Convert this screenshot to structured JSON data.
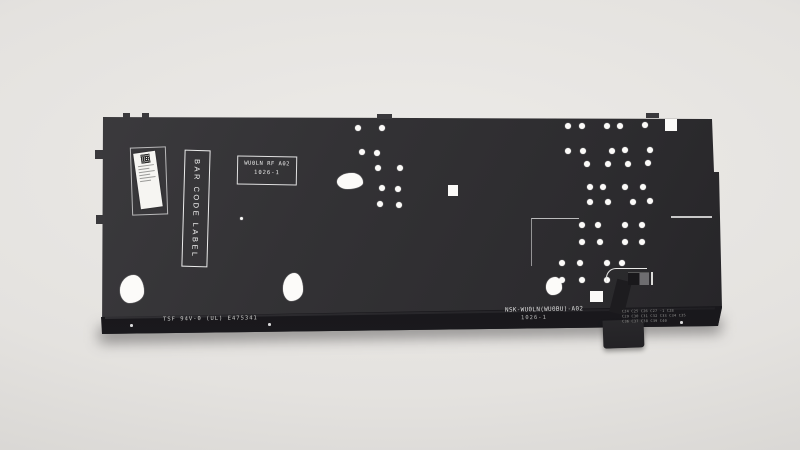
{
  "scene": {
    "description": "Product photo of a laptop keyboard backplate (NSK-WU0LN) on a light gray studio background",
    "background_color": "#e7e5e2",
    "panel_color": "#323134",
    "strip_color": "#18171a",
    "hole_color": "#fbfaf8"
  },
  "markings": {
    "stamp_line1": "WU0LN RF A02",
    "stamp_line2": "1026-1",
    "barcode_box_label": "BAR CODE LABEL",
    "ul_marking": "TSF 94V-0 (UL) E475341",
    "part_number": "NSK-WU0LN(WU0BU)-A02",
    "date_code": "1026-1",
    "component_refs": [
      "C24 C25 C26 C27 -1 C28",
      "C29 C30 C31 C32 C33 C34 C35",
      "C36 C37 C38 C39 C40"
    ]
  },
  "panel": {
    "holes": [
      [
        263,
        18
      ],
      [
        287,
        18
      ],
      [
        267,
        42
      ],
      [
        282,
        43
      ],
      [
        283,
        58
      ],
      [
        305,
        58
      ],
      [
        287,
        78
      ],
      [
        303,
        79
      ],
      [
        285,
        94
      ],
      [
        304,
        95
      ],
      [
        473,
        16
      ],
      [
        487,
        16
      ],
      [
        512,
        16
      ],
      [
        525,
        16
      ],
      [
        550,
        15
      ],
      [
        473,
        41
      ],
      [
        488,
        41
      ],
      [
        517,
        41
      ],
      [
        530,
        40
      ],
      [
        555,
        40
      ],
      [
        492,
        54
      ],
      [
        513,
        54
      ],
      [
        533,
        54
      ],
      [
        553,
        53
      ],
      [
        495,
        77
      ],
      [
        508,
        77
      ],
      [
        530,
        77
      ],
      [
        548,
        77
      ],
      [
        495,
        92
      ],
      [
        513,
        92
      ],
      [
        538,
        92
      ],
      [
        555,
        91
      ],
      [
        487,
        115
      ],
      [
        503,
        115
      ],
      [
        530,
        115
      ],
      [
        547,
        115
      ],
      [
        487,
        132
      ],
      [
        505,
        132
      ],
      [
        530,
        132
      ],
      [
        547,
        132
      ],
      [
        467,
        153
      ],
      [
        485,
        153
      ],
      [
        512,
        153
      ],
      [
        527,
        153
      ],
      [
        467,
        170
      ],
      [
        487,
        170
      ],
      [
        512,
        170
      ]
    ],
    "small_holes": [
      [
        146,
        108
      ]
    ],
    "square_holes": [
      [
        353,
        75,
        10,
        11
      ],
      [
        570,
        9,
        12,
        12
      ],
      [
        495,
        181,
        13,
        11
      ]
    ],
    "stabilizer_cutouts": [
      [
        242,
        63,
        26,
        16
      ],
      [
        25,
        165,
        24,
        28
      ],
      [
        188,
        163,
        20,
        28
      ],
      [
        451,
        167,
        16,
        18
      ]
    ],
    "edge_tabs_left": [
      [
        0,
        40,
        9,
        9
      ],
      [
        1,
        105,
        9,
        9
      ]
    ],
    "edge_tabs_top": [
      [
        28,
        3,
        7,
        5
      ],
      [
        47,
        3,
        7,
        5
      ],
      [
        282,
        4,
        15,
        5
      ],
      [
        551,
        3,
        13,
        5
      ]
    ]
  }
}
